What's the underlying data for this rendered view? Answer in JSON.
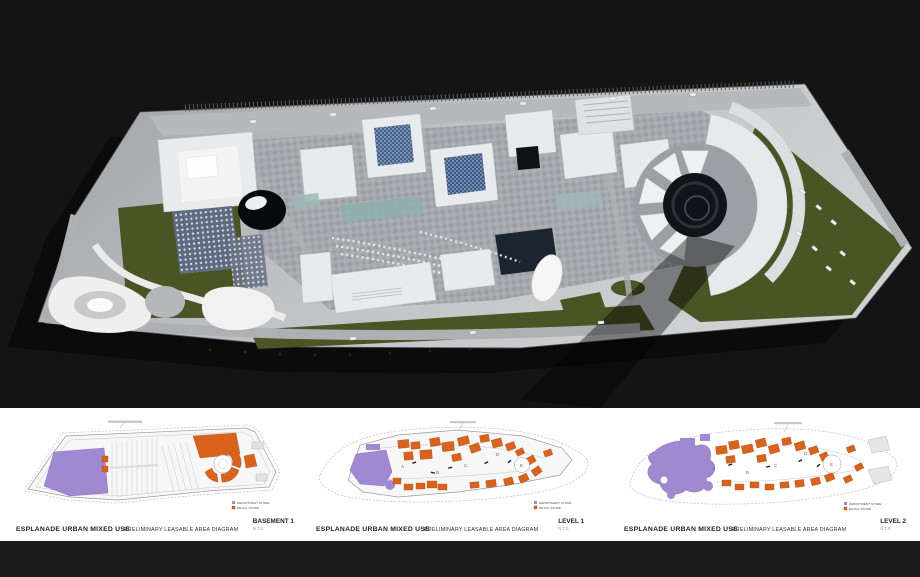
{
  "page": {
    "bg_top": "#141414",
    "bg_band": "#ffffff",
    "bg_strip": "#1c1c1c"
  },
  "colors": {
    "department_store": "#a189d2",
    "retail_store": "#d9631d",
    "boundary_pink": "#eda8cc",
    "site_green": "#4b5425",
    "building_white": "#e9eaec",
    "plaza_gray": "#a6a9ad",
    "pool_navy": "#1b2530"
  },
  "aerial": {
    "name": "site-aerial-render"
  },
  "panels": [
    {
      "project_title": "ESPLANADE URBAN MIXED USE",
      "diagram_title": "PRELIMINARY LEASABLE AREA DIAGRAM",
      "level_label": "BASEMENT 1",
      "scale_label": "N.T.S.",
      "legend": [
        {
          "label": "DEPARTMENT STORE",
          "color": "#a189d2"
        },
        {
          "label": "RETAIL STORE",
          "color": "#d9631d"
        }
      ],
      "zones": []
    },
    {
      "project_title": "ESPLANADE URBAN MIXED USE",
      "diagram_title": "PRELIMINARY LEASABLE AREA DIAGRAM",
      "level_label": "LEVEL 1",
      "scale_label": "N.T.S.",
      "legend": [
        {
          "label": "DEPARTMENT STORE",
          "color": "#a189d2"
        },
        {
          "label": "RETAIL STORE",
          "color": "#d9631d"
        }
      ],
      "zones": [
        "A",
        "B",
        "C",
        "D",
        "E"
      ]
    },
    {
      "project_title": "ESPLANADE URBAN MIXED USE",
      "diagram_title": "PRELIMINARY LEASABLE AREA DIAGRAM",
      "level_label": "LEVEL 2",
      "scale_label": "N.T.S.",
      "legend": [
        {
          "label": "DEPARTMENT STORE",
          "color": "#a189d2"
        },
        {
          "label": "RETAIL STORE",
          "color": "#d9631d"
        }
      ],
      "zones": [
        "A",
        "B",
        "C",
        "D",
        "E"
      ]
    }
  ]
}
